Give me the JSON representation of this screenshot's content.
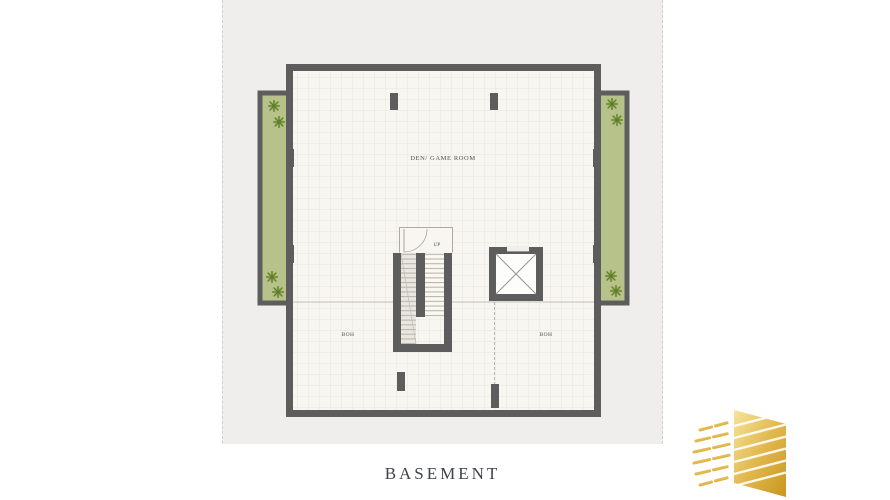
{
  "sheet": {
    "title": "BASEMENT",
    "background": "#efeeec",
    "page_background": "#ffffff"
  },
  "plan": {
    "labels": {
      "main_room": "DEN/ GAME ROOM",
      "stairs_up": "UP",
      "boh_left": "BOH",
      "boh_right": "BOH"
    },
    "colors": {
      "wall": "#5d5d5d",
      "floor": "#f7f6f1",
      "planter_fill": "#b6c289",
      "plant_mark": "#5f7d2a",
      "label_text": "#55504a",
      "title_text": "#41434b"
    },
    "features": [
      "planter-left",
      "planter-right",
      "staircase",
      "elevator",
      "columns"
    ]
  },
  "logo": {
    "icon": "gold-building-logo-icon",
    "gradient_from": "#f6e59c",
    "gradient_to": "#c8961e"
  }
}
